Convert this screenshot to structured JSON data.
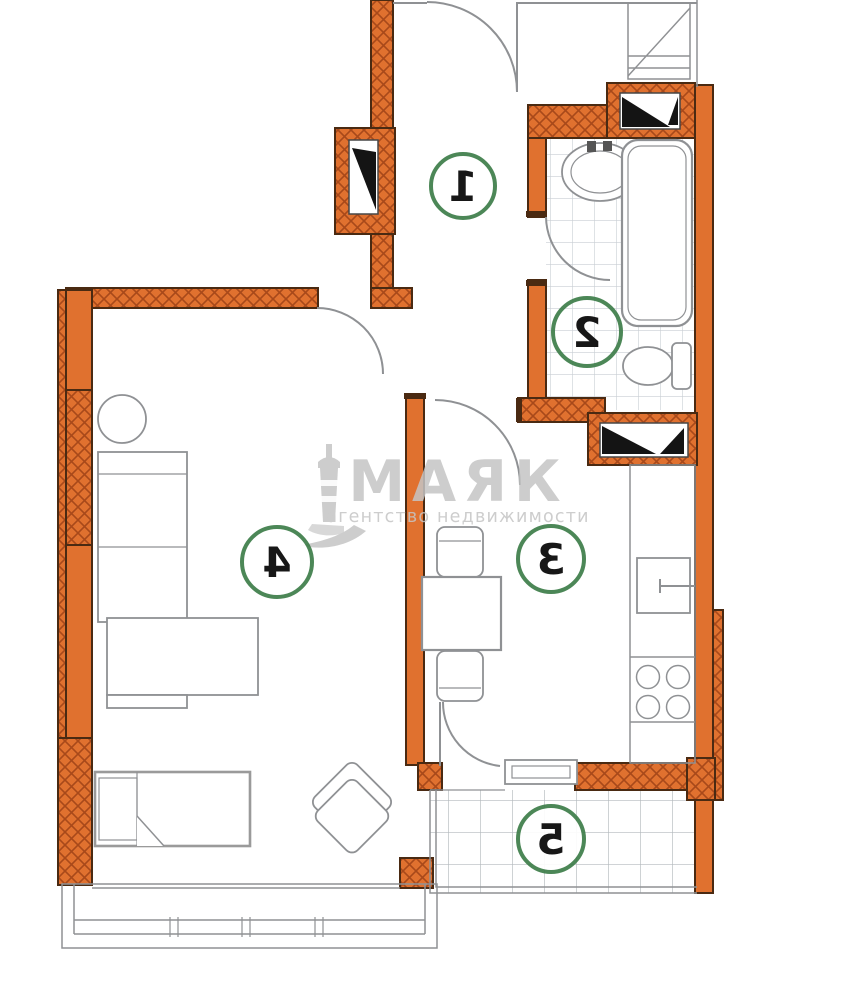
{
  "watermark": {
    "brand": "МАЯК",
    "subtitle": "агентство недвижимости"
  },
  "rooms": [
    {
      "label": "1"
    },
    {
      "label": "2"
    },
    {
      "label": "3"
    },
    {
      "label": "4"
    },
    {
      "label": "5"
    }
  ],
  "colors": {
    "wall_fill": "#e0712f",
    "wall_hatch": "#a8491a",
    "wall_outline": "#4a2a12",
    "plan_line": "#8f9194",
    "bed_line": "#9a9a9a",
    "tile_line": "#c9ced4",
    "balcony_tile_line": "#b3b9be",
    "room_circle": "#3d7d49",
    "digit": "#171717",
    "watermark": "#c5c5c5",
    "background": "#ffffff"
  }
}
